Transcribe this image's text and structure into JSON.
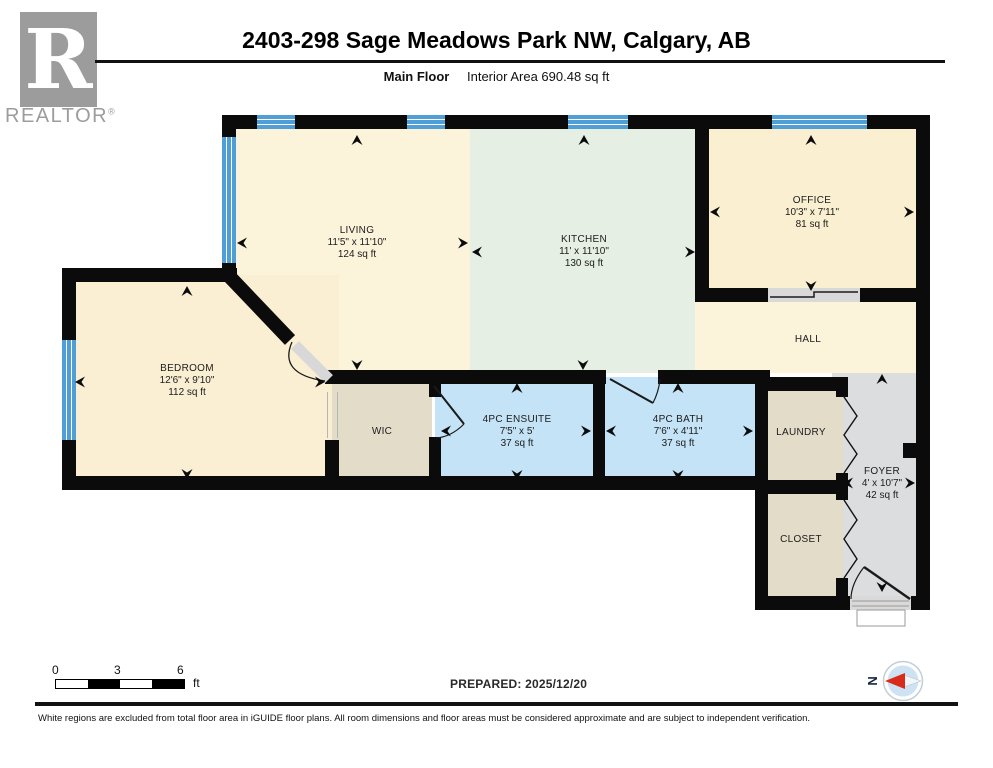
{
  "header": {
    "brand": {
      "logo_letter": "R",
      "logo_label": "REALTOR",
      "registered_mark": "®"
    },
    "title": "2403-298 Sage Meadows Park NW, Calgary, AB",
    "floor_label": "Main Floor",
    "area_label": "Interior Area 690.48 sq ft"
  },
  "rooms": {
    "living": {
      "name": "LIVING",
      "dims": "11'5\" x 11'10\"",
      "area": "124 sq ft"
    },
    "kitchen": {
      "name": "KITCHEN",
      "dims": "11' x 11'10\"",
      "area": "130 sq ft"
    },
    "office": {
      "name": "OFFICE",
      "dims": "10'3\" x 7'11\"",
      "area": "81 sq ft"
    },
    "bedroom": {
      "name": "BEDROOM",
      "dims": "12'6\" x 9'10\"",
      "area": "112 sq ft"
    },
    "ensuite": {
      "name": "4PC ENSUITE",
      "dims": "7'5\" x 5'",
      "area": "37 sq ft"
    },
    "bath": {
      "name": "4PC BATH",
      "dims": "7'6\" x 4'11\"",
      "area": "37 sq ft"
    },
    "foyer": {
      "name": "FOYER",
      "dims": "4' x 10'7\"",
      "area": "42 sq ft"
    },
    "wic": {
      "name": "WIC"
    },
    "hall": {
      "name": "HALL"
    },
    "laundry": {
      "name": "LAUNDRY"
    },
    "closet": {
      "name": "CLOSET"
    }
  },
  "scale_bar": {
    "tick0": "0",
    "tick1": "3",
    "tick2": "6",
    "unit": "ft"
  },
  "footer": {
    "prepared": "PREPARED: 2025/12/20",
    "compass_letter": "N",
    "disclaimer": "White regions are excluded from total floor area in iGUIDE floor plans. All room dimensions and floor areas must be considered approximate and are subject to independent verification."
  },
  "colors": {
    "wall": "#0b0b0b",
    "window_blue": "#4f9fd6",
    "room_cream": "#fbf2d7",
    "room_green": "#e6efe4",
    "room_blue": "#c4e3f6",
    "room_beige": "#e2dcc9",
    "room_gray": "#dcddde",
    "logo_gray": "#9c9c9c",
    "compass_red": "#d92b1c"
  }
}
